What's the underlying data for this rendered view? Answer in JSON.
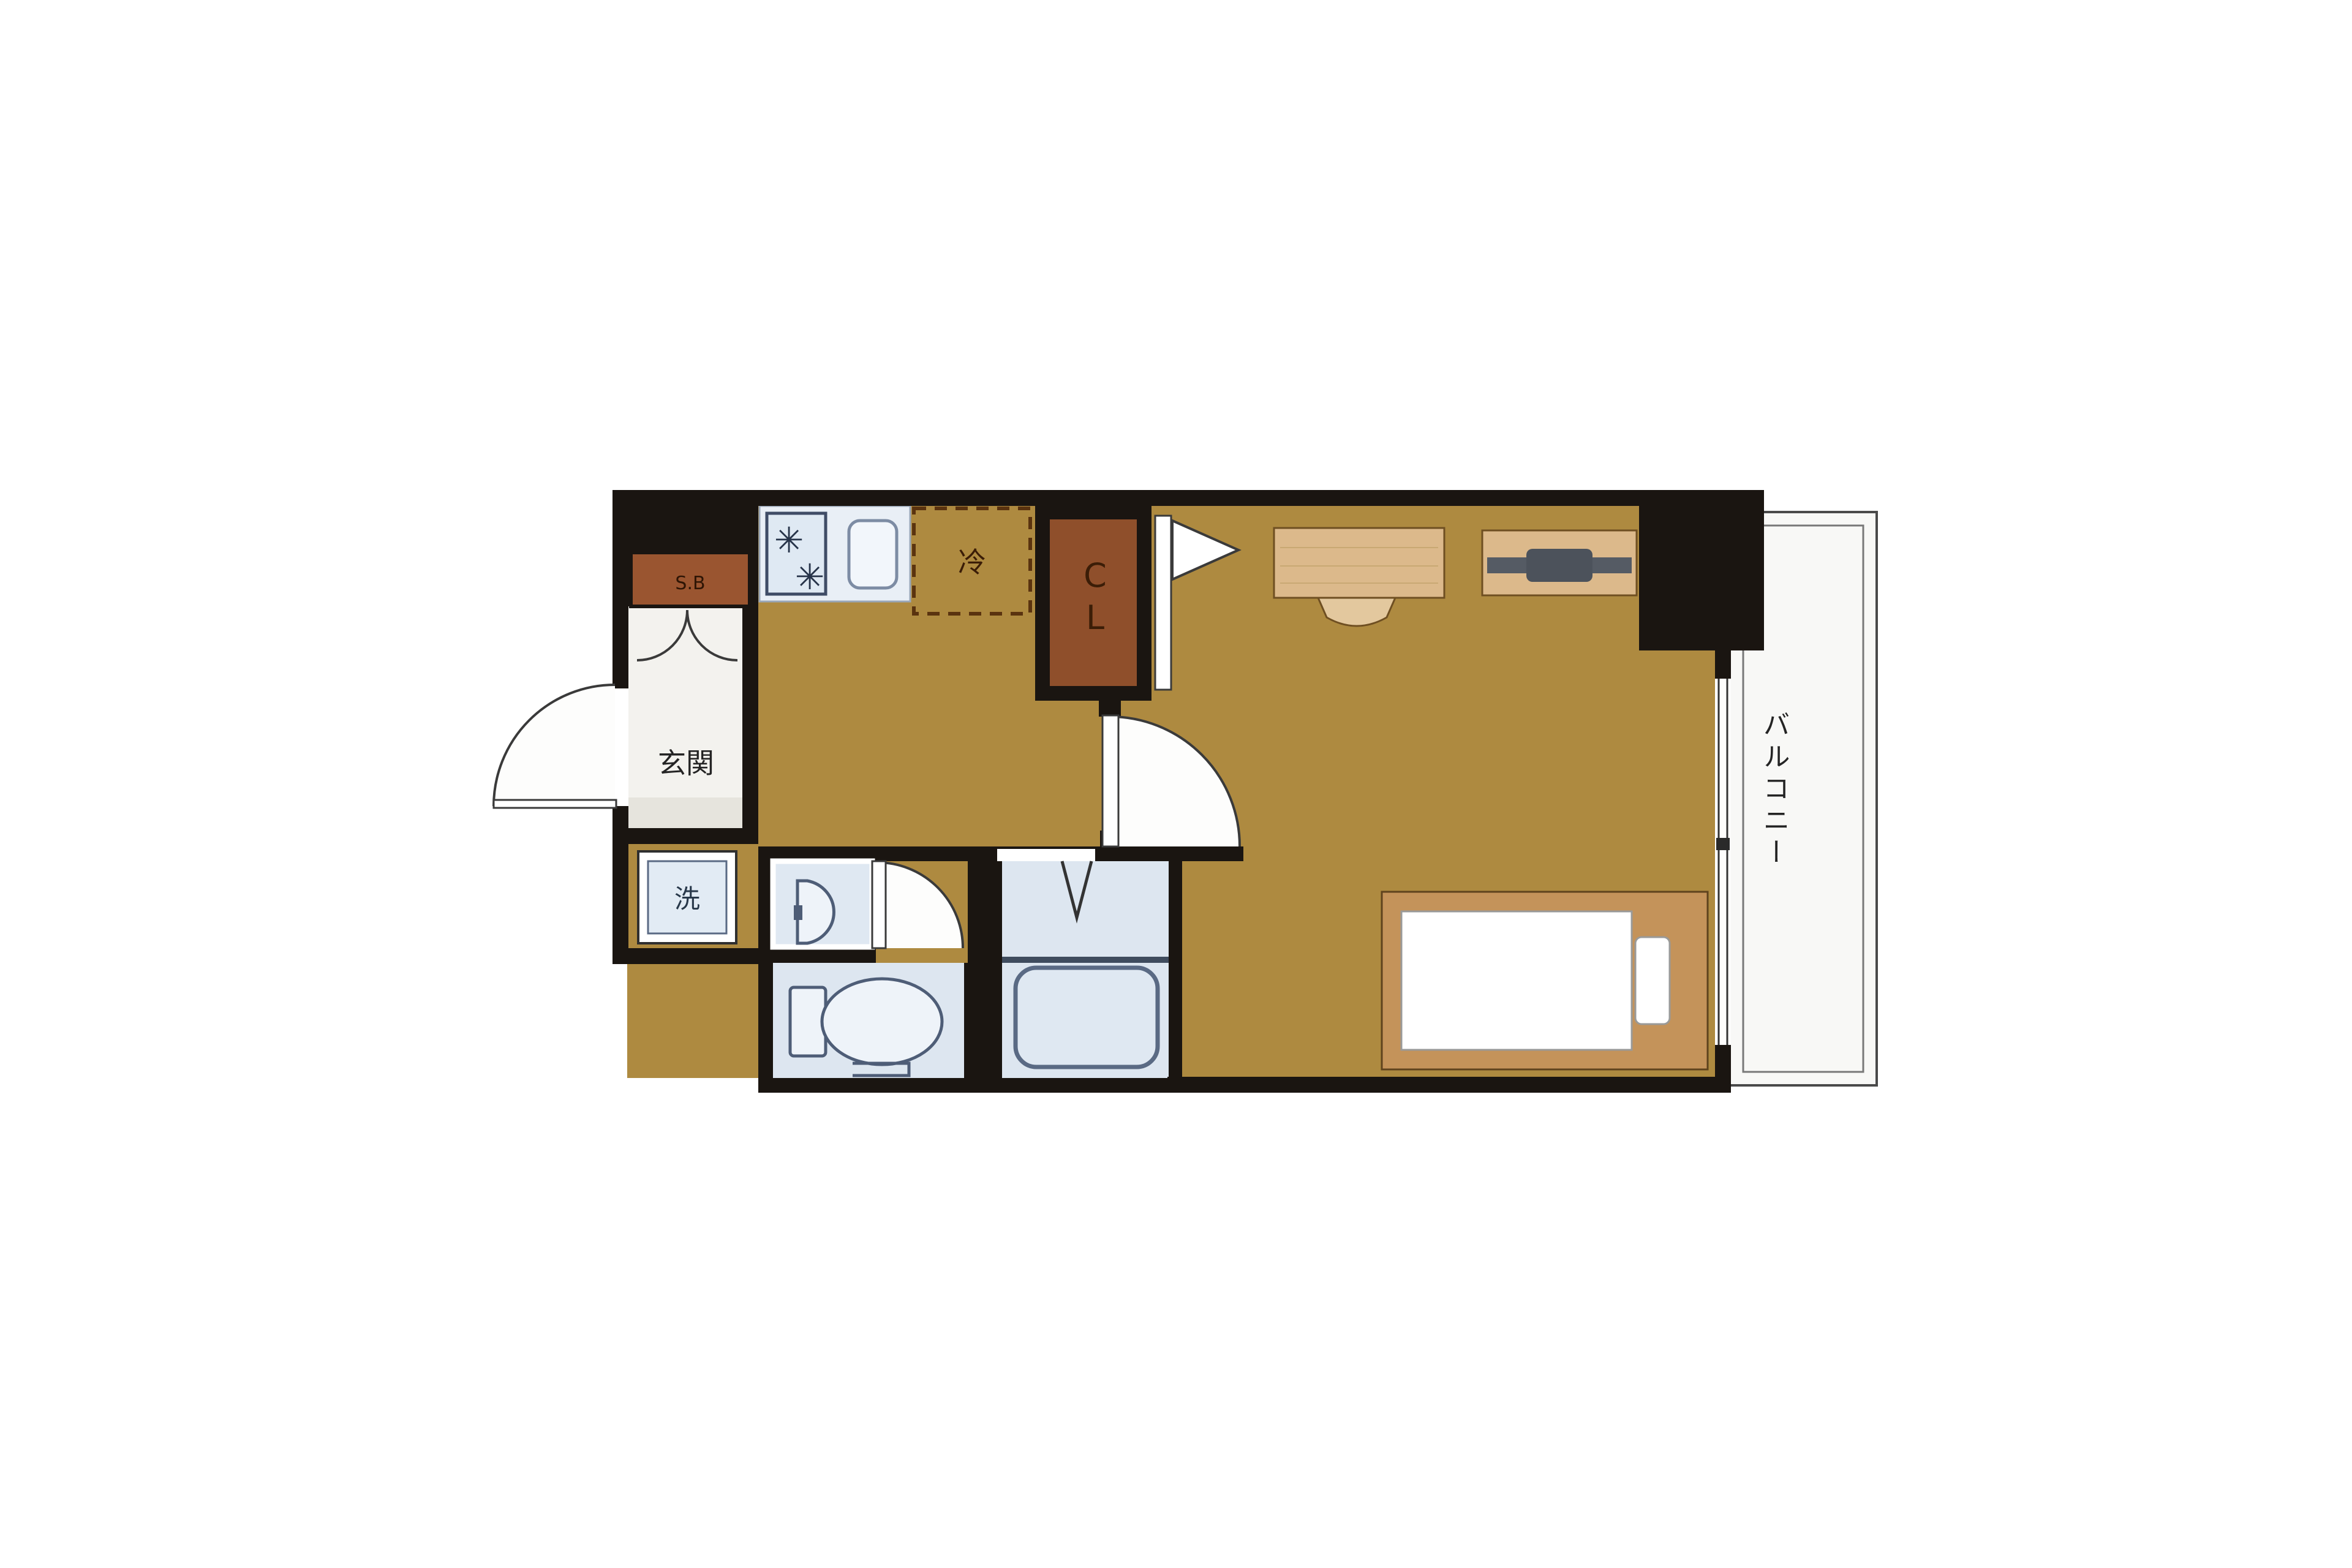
{
  "floor_plan": {
    "labels": {
      "entrance": "玄関",
      "shoe_box": "S.B",
      "washer": "洗",
      "refrigerator": "冷",
      "closet": "CL",
      "balcony": "バルコニー"
    },
    "icons": {
      "stove_burner": "✳"
    },
    "colors": {
      "floor": "#ae8a40",
      "wall": "#1a1511",
      "closet_fill": "#8f4f2b",
      "shoe_box_fill": "#9a5530",
      "wet_room_floor": "#dde6f0",
      "fixture_fill": "#e9eff6",
      "entrance_floor": "#f3f2ee",
      "wood_fill": "#dcb98b",
      "bed_frame_fill": "#c4935a",
      "balcony_fill": "#f8f8f6"
    }
  }
}
